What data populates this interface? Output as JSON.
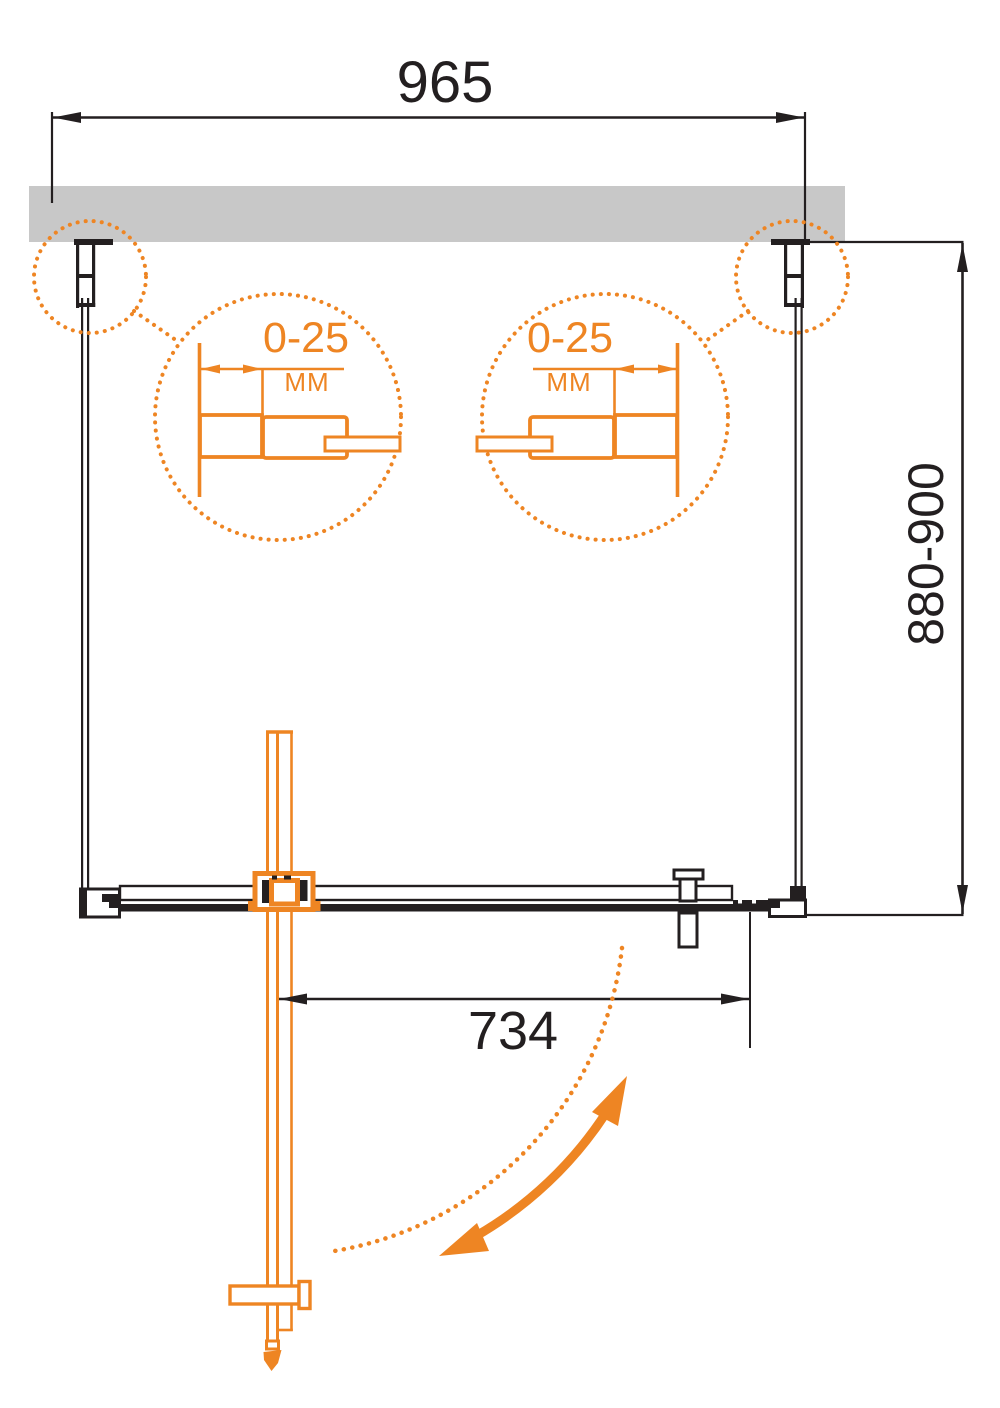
{
  "diagram": {
    "dimensions": {
      "overall_width": "965",
      "installation_height": "880-900",
      "door_width": "734"
    },
    "detail_callouts": [
      {
        "adjustment_range": "0-25",
        "unit": "MM"
      },
      {
        "adjustment_range": "0-25",
        "unit": "MM"
      }
    ],
    "colors": {
      "accent_orange": "#EE8523",
      "line_black": "#231F20",
      "wall_gray": "#C8C8C8"
    }
  }
}
